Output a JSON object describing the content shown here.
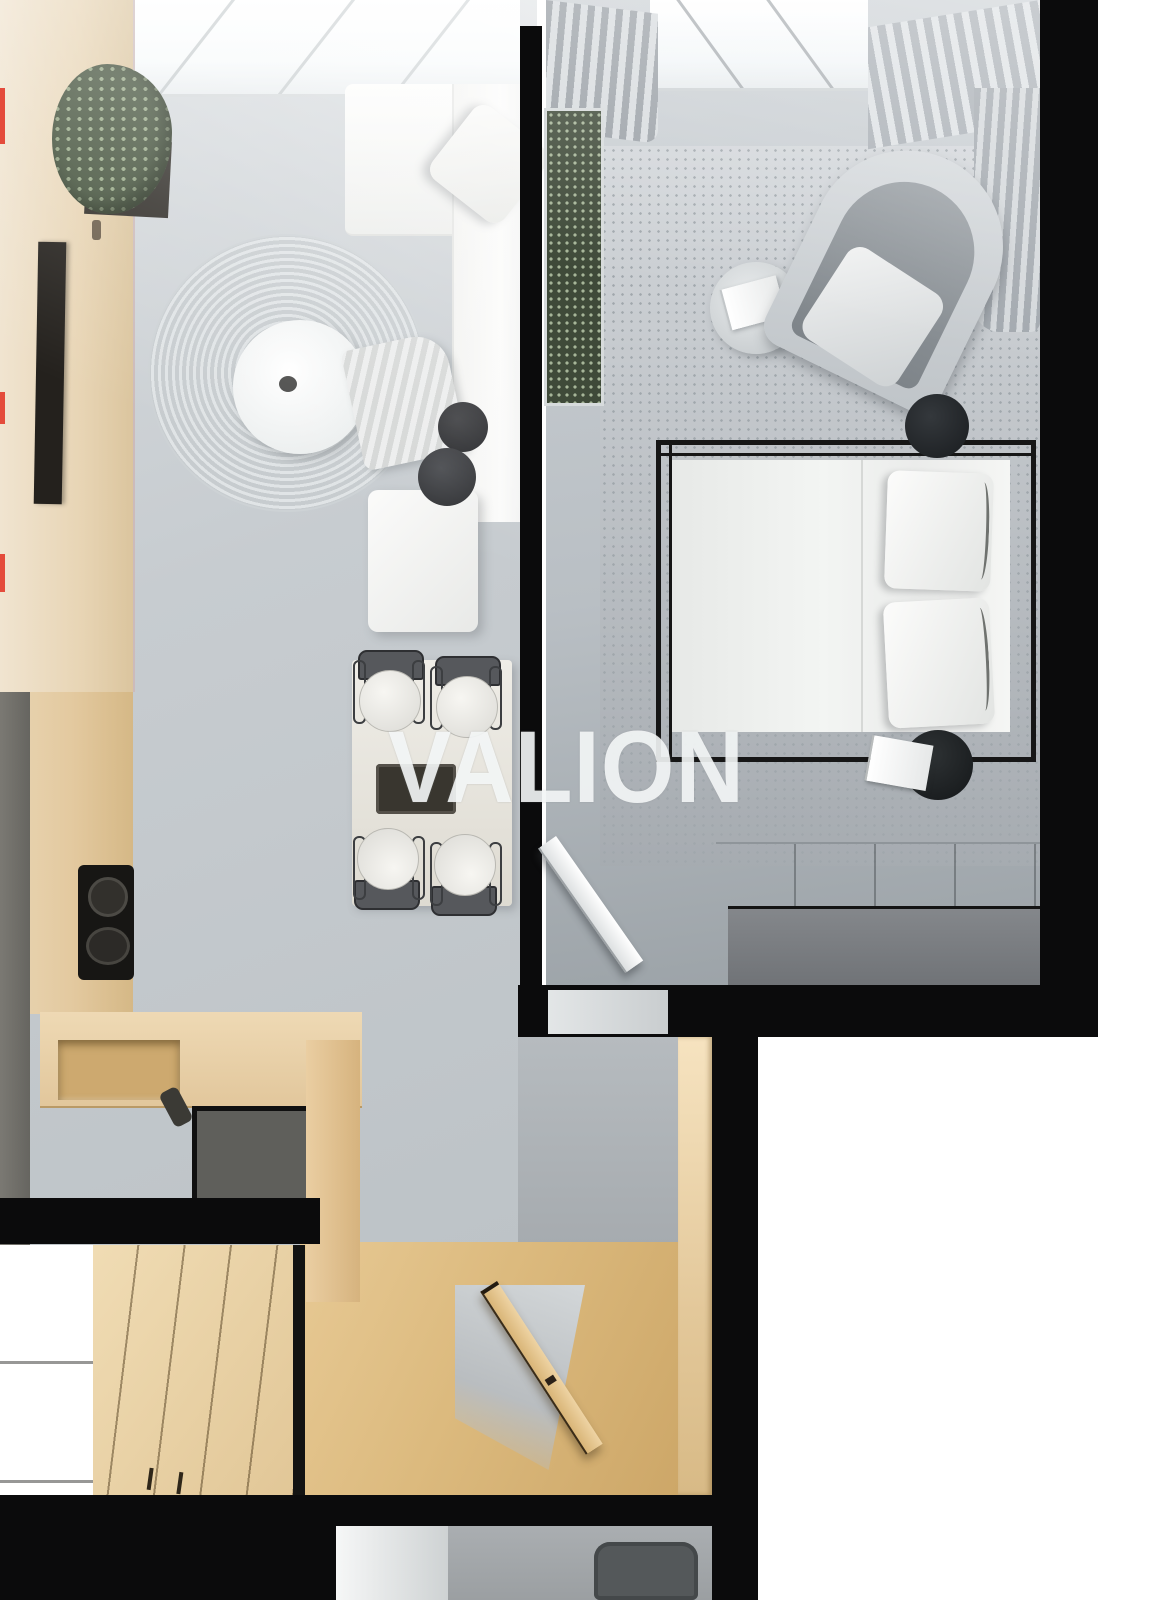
{
  "watermark": {
    "text": "VALION",
    "color_hex": "#f8fafa",
    "opacity": 0.87
  },
  "scene": {
    "type": "apartment-floor-plan-3d-render",
    "view": "top-down",
    "rooms": [
      {
        "name": "living-room",
        "furniture": [
          "panoramic-window",
          "potted-plant",
          "wooden-sideboard",
          "television",
          "round-woven-rug",
          "round-coffee-table",
          "white-corner-sofa",
          "throw-pillow",
          "throw-blanket",
          "black-side-table-pair",
          "white-ottoman"
        ]
      },
      {
        "name": "dining-area",
        "furniture": [
          "dining-table",
          "serving-tray",
          "dining-chair-1",
          "dining-chair-2",
          "dining-chair-3",
          "dining-chair-4"
        ]
      },
      {
        "name": "kitchen",
        "furniture": [
          "tall-wood-cabinets",
          "cooktop",
          "l-shaped-counter",
          "sink-recess",
          "faucet"
        ]
      },
      {
        "name": "bedroom",
        "furniture": [
          "curtain-left",
          "window",
          "curtain-right",
          "vertical-wall-planter",
          "round-side-table",
          "open-book",
          "egg-armchair",
          "black-canopy-bed",
          "mattress",
          "pillow-1",
          "pillow-2",
          "round-nightstand-top",
          "round-nightstand-bottom",
          "notebook",
          "storage-bench",
          "open-white-door"
        ]
      },
      {
        "name": "hallway",
        "furniture": [
          "gray-wardrobe",
          "wood-sliding-wardrobe",
          "wood-floor",
          "open-entry-door"
        ]
      },
      {
        "name": "bathroom-glimpse",
        "furniture": [
          "white-door-panel",
          "toilet"
        ]
      }
    ]
  },
  "palette": {
    "background": "#ffffff",
    "walls_black": "#0b0b0c",
    "concrete_floor": "#c3c8cd",
    "bedroom_floor": "#b9bfc4",
    "wood_light": "#e8d2a8",
    "wood_floor": "#dcba7e",
    "sofa_white": "#f4f4f2",
    "plant_green": "#46543e",
    "watermark_white": "#f8fafa",
    "artifact_red": "#e23a2a"
  }
}
